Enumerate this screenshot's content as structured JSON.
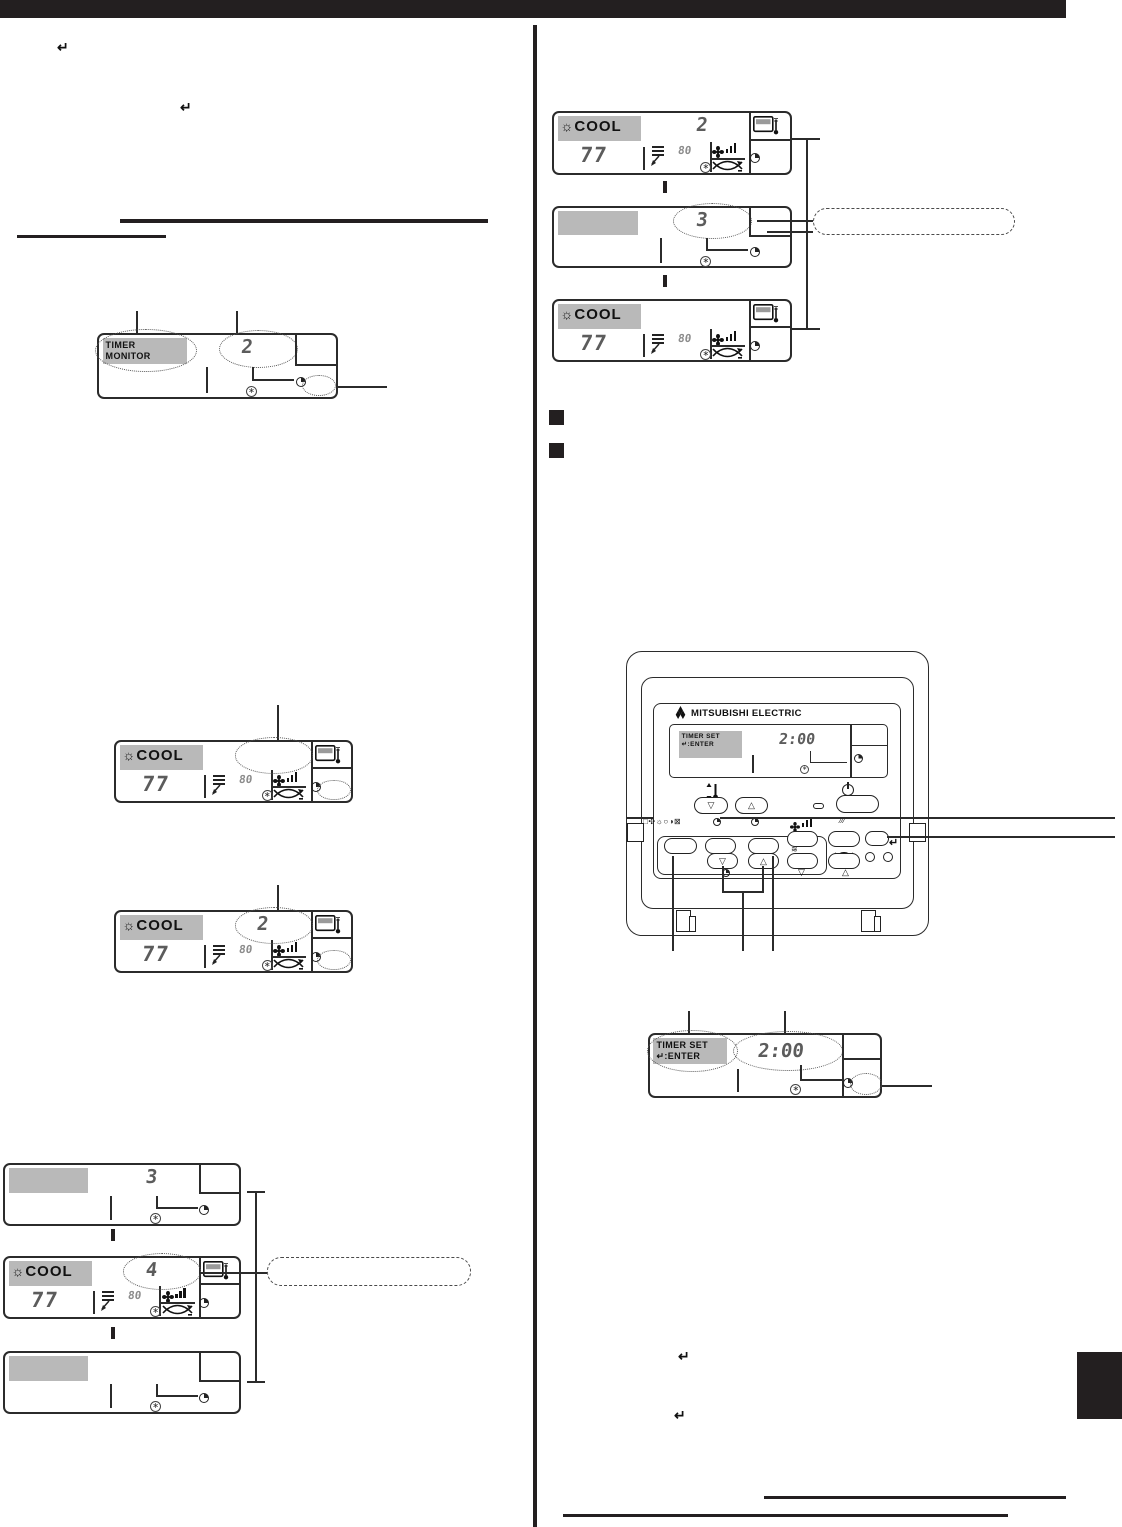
{
  "colors": {
    "ink": "#231f20",
    "highlight_gray": "#b9b9b9"
  },
  "glyphs": {
    "enter": "↵",
    "asterisk": "∗",
    "down": "▽",
    "up": "△",
    "sun": "☼",
    "mode_cluster": "□✣☼○◑⊠",
    "wave": "≋",
    "slashes": "⁄⁄⁄"
  },
  "left": {
    "enter1": "↵",
    "enter2": "↵",
    "lcd_timer_monitor": {
      "line1": "TIMER",
      "line2": "MONITOR",
      "value": "2"
    },
    "lcd_cool_pending": {
      "mode": "COOL",
      "temp": "77",
      "sub": "80",
      "value": ""
    },
    "lcd_cool_set": {
      "mode": "COOL",
      "temp": "77",
      "sub": "80",
      "value": "2"
    },
    "seq_top": {
      "value": "3"
    },
    "seq_mid": {
      "mode": "COOL",
      "temp": "77",
      "sub": "80",
      "value": "4"
    }
  },
  "right": {
    "seq_top": {
      "mode": "COOL",
      "temp": "77",
      "sub": "80",
      "value": "2"
    },
    "seq_mid": {
      "value": "3"
    },
    "seq_bot": {
      "mode": "COOL",
      "temp": "77",
      "sub": "80"
    },
    "remote": {
      "brand": "MITSUBISHI ELECTRIC",
      "lcd": {
        "line1": "TIMER SET",
        "line2": "↵:ENTER",
        "time": "2:00"
      },
      "enter": "↵"
    },
    "lcd_timer_set": {
      "line1": "TIMER SET",
      "line2": "↵:ENTER",
      "time": "2:00"
    },
    "enter3": "↵",
    "enter4": "↵"
  }
}
